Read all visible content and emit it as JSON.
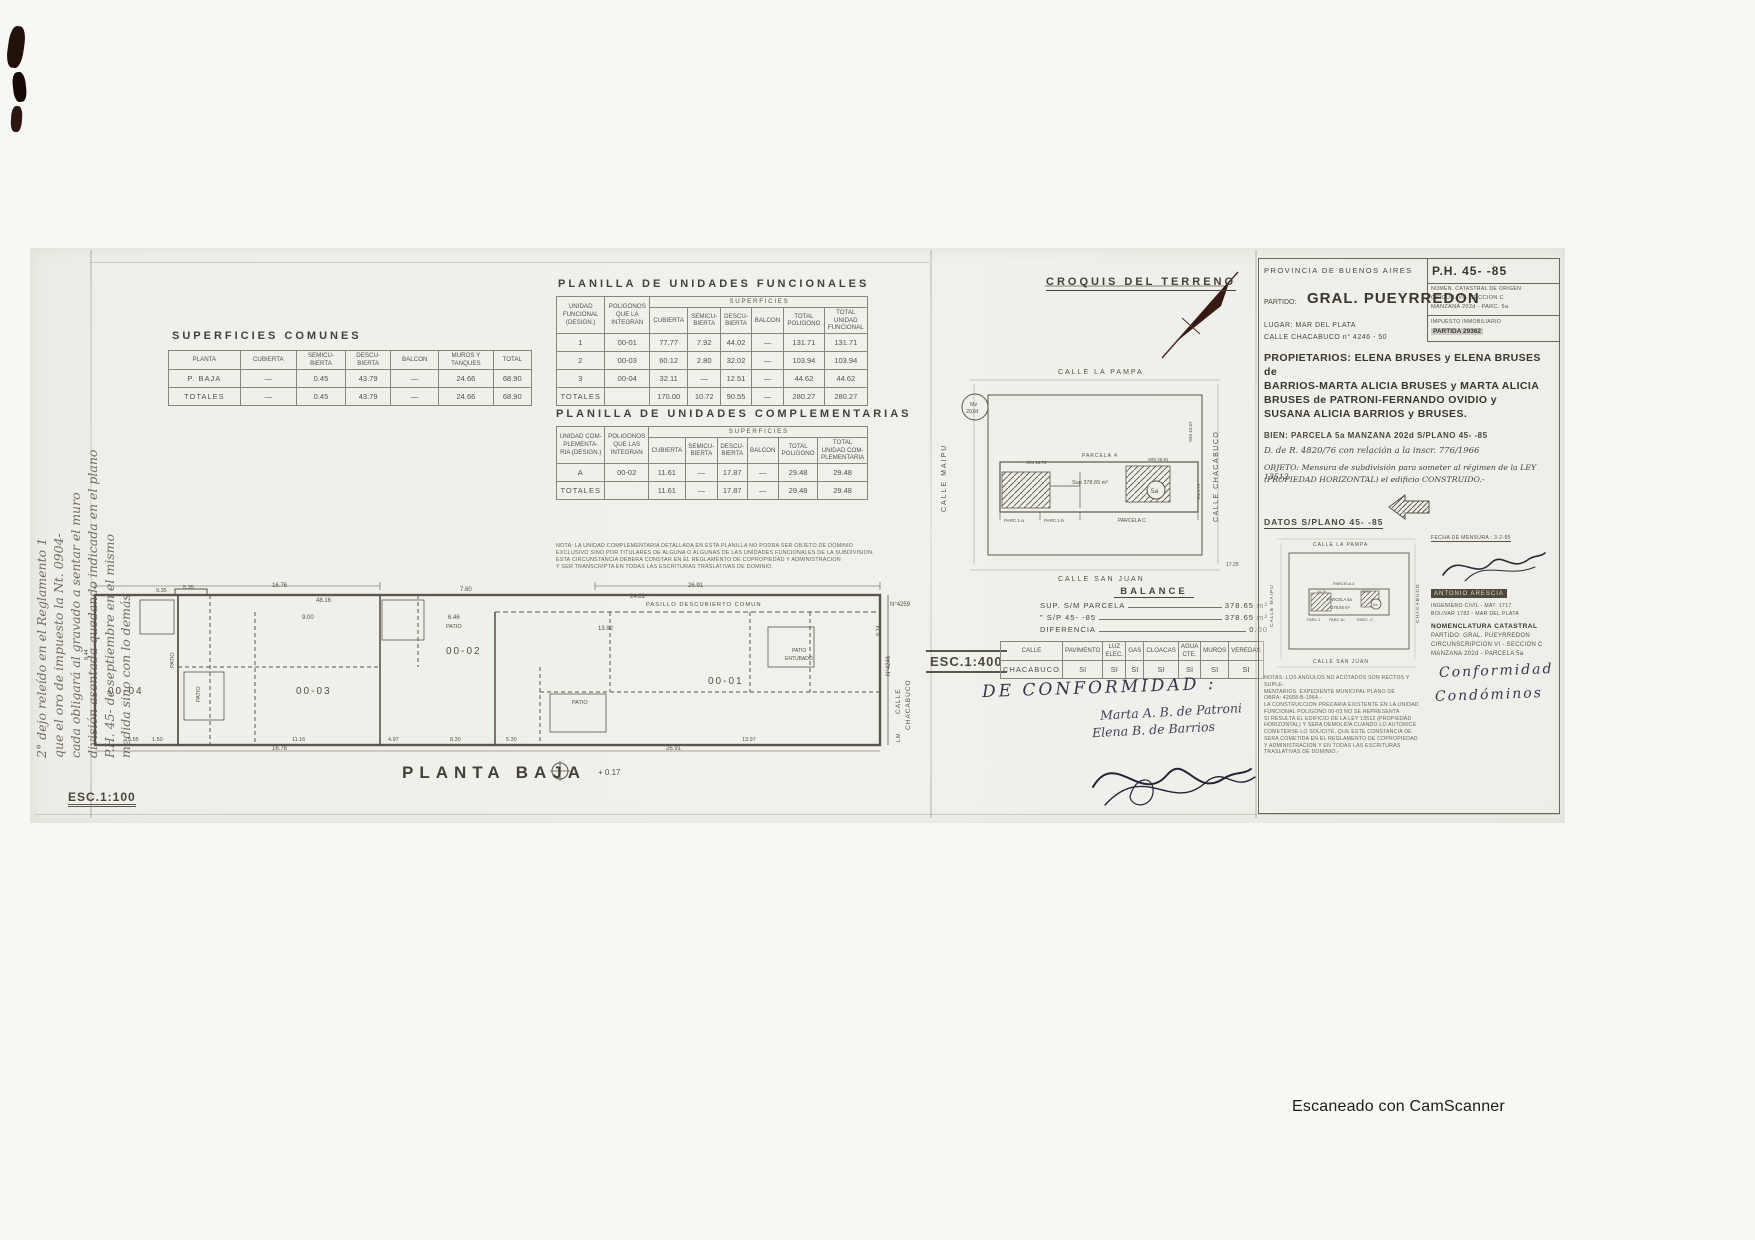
{
  "footer": {
    "camscanner": "Escaneado con CamScanner"
  },
  "margin_note": {
    "lines": [
      "2° dejo releído en el Reglamento 1",
      "que el oro de impuesto la Nt. 0904-",
      "cada obligará al gravado a sentar el muro",
      "división asentada quedando indicada en el plano",
      "P.H. 45- de septiembre en el mismo",
      "medida sino con lo demás"
    ]
  },
  "superficies_comunes": {
    "title": "SUPERFICIES COMUNES",
    "header_rows": [
      [
        {
          "t": "PLANTA"
        },
        {
          "t": "CUBIERTA"
        },
        {
          "t": "SEMICU-\nBIERTA"
        },
        {
          "t": "DESCU-\nBIERTA"
        },
        {
          "t": "BALCON"
        },
        {
          "t": "MUROS Y\nTANQUES"
        },
        {
          "t": "TOTAL"
        }
      ]
    ],
    "rows": [
      [
        "P. BAJA",
        "—",
        "0.45",
        "43.79",
        "—",
        "24.66",
        "68.90"
      ],
      [
        "TOTALES",
        "—",
        "0.45",
        "43.79",
        "—",
        "24.66",
        "68.90"
      ]
    ]
  },
  "unidades_funcionales": {
    "title": "PLANILLA DE UNIDADES FUNCIONALES",
    "header_rows": [
      [
        {
          "t": "UNIDAD\nFUNCIONAL\n(DESIGN.)",
          "r": 2
        },
        {
          "t": "POLIGONOS\nQUE LA\nINTEGRAN",
          "r": 2
        },
        {
          "t": "S U P E R F I C I E S",
          "c": 6
        }
      ],
      [
        {
          "t": "CUBIERTA"
        },
        {
          "t": "SEMICU-\nBIERTA"
        },
        {
          "t": "DESCU-\nBIERTA"
        },
        {
          "t": "BALCON"
        },
        {
          "t": "TOTAL\nPOLIGONO"
        },
        {
          "t": "TOTAL\nUNIDAD\nFUNCIONAL"
        }
      ]
    ],
    "rows": [
      [
        "1",
        "00-01",
        "77.77",
        "7.92",
        "44.02",
        "—",
        "131.71",
        "131.71"
      ],
      [
        "2",
        "00-03",
        "60.12",
        "2.80",
        "32.02",
        "—",
        "103.94",
        "103.94"
      ],
      [
        "3",
        "00-04",
        "32.11",
        "—",
        "12.51",
        "—",
        "44.62",
        "44.62"
      ],
      [
        "TOTALES",
        "",
        "170.00",
        "10.72",
        "90.55",
        "—",
        "280.27",
        "280.27"
      ]
    ]
  },
  "unidades_complementarias": {
    "title": "PLANILLA DE UNIDADES COMPLEMENTARIAS",
    "header_rows": [
      [
        {
          "t": "UNIDAD COM-\nPLEMENTA-\nRIA (DESIGN.)",
          "r": 2
        },
        {
          "t": "POLIGONOS\nQUE LAS\nINTEGRAN",
          "r": 2
        },
        {
          "t": "S U P E R F I C I E S",
          "c": 6
        }
      ],
      [
        {
          "t": "CUBIERTA"
        },
        {
          "t": "SEMICU-\nBIERTA"
        },
        {
          "t": "DESCU-\nBIERTA"
        },
        {
          "t": "BALCON"
        },
        {
          "t": "TOTAL\nPOLIGONO"
        },
        {
          "t": "TOTAL\nUNIDAD COM-\nPLEMENTARIA"
        }
      ]
    ],
    "rows": [
      [
        "A",
        "00-02",
        "11.61",
        "—",
        "17.87",
        "—",
        "29.48",
        "29.48"
      ],
      [
        "TOTALES",
        "",
        "11.61",
        "—",
        "17.87",
        "—",
        "29.48",
        "29.48"
      ]
    ],
    "nota_lines": [
      "NOTA: LA UNIDAD COMPLEMENTARIA DETALLADA EN ESTA PLANILLA NO PODRA SER OBJETO DE DOMINIO",
      "EXCLUSIVO SINO POR TITULARES DE ALGUNA O ALGUNAS DE LAS UNIDADES FUNCIONALES DE LA SUBDIVISION.",
      "ESTA CIRCUNSTANCIA DEBERA CONSTAR EN EL REGLAMENTO DE COPROPIEDAD Y ADMINISTRACION",
      "Y SER TRANSCRIPTA EN TODAS LAS ESCRITURAS TRASLATIVAS DE DOMINIO."
    ]
  },
  "plan": {
    "esc": "ESC.1:100",
    "labels": [
      {
        "t": "9.35",
        "x": 106,
        "y": 20,
        "s": 5.5
      },
      {
        "t": "5.35",
        "x": 133,
        "y": 17,
        "s": 5.5
      },
      {
        "t": "16.76",
        "x": 222,
        "y": 15,
        "s": 6
      },
      {
        "t": "48.16",
        "x": 266,
        "y": 30,
        "s": 6
      },
      {
        "t": "9.00",
        "x": 252,
        "y": 47,
        "s": 6
      },
      {
        "t": "7.60",
        "x": 410,
        "y": 19,
        "s": 6
      },
      {
        "t": "6.46",
        "x": 398,
        "y": 47,
        "s": 6
      },
      {
        "t": "24.81",
        "x": 580,
        "y": 26,
        "s": 6
      },
      {
        "t": "26.91",
        "x": 638,
        "y": 15,
        "s": 6
      },
      {
        "t": "13.92",
        "x": 548,
        "y": 58,
        "s": 6
      },
      {
        "t": "PASILLO  DESCUBIERTO  COMUN",
        "x": 596,
        "y": 34,
        "s": 5.8,
        "sp": 1
      },
      {
        "t": "5.55",
        "x": 78,
        "y": 169,
        "s": 5.5
      },
      {
        "t": "1.50",
        "x": 102,
        "y": 169,
        "s": 5.5
      },
      {
        "t": "16.76",
        "x": 222,
        "y": 178,
        "s": 6
      },
      {
        "t": "11.16",
        "x": 242,
        "y": 169,
        "s": 5.5
      },
      {
        "t": "4.97",
        "x": 338,
        "y": 169,
        "s": 5.5
      },
      {
        "t": "8.30",
        "x": 400,
        "y": 169,
        "s": 5.5
      },
      {
        "t": "5.30",
        "x": 456,
        "y": 169,
        "s": 5.5
      },
      {
        "t": "26.91",
        "x": 616,
        "y": 178,
        "s": 6
      },
      {
        "t": "13.97",
        "x": 692,
        "y": 169,
        "s": 5.5
      },
      {
        "t": "8.44",
        "x": 38,
        "y": 88,
        "s": 5.5,
        "r": -90
      },
      {
        "t": "8.74",
        "x": 830,
        "y": 64,
        "s": 5.5,
        "r": -90
      },
      {
        "t": "N°4259",
        "x": 840,
        "y": 34,
        "s": 6
      },
      {
        "t": "N°4246",
        "x": 840,
        "y": 104,
        "r": -90,
        "s": 6
      },
      {
        "t": "00-04",
        "x": 58,
        "y": 122,
        "s": 10,
        "sp": 2
      },
      {
        "t": "00-03",
        "x": 246,
        "y": 122,
        "s": 10,
        "sp": 2
      },
      {
        "t": "00-02",
        "x": 396,
        "y": 82,
        "s": 10,
        "sp": 2
      },
      {
        "t": "00-01",
        "x": 658,
        "y": 112,
        "s": 10,
        "sp": 2
      },
      {
        "t": "PATIO",
        "x": 124,
        "y": 96,
        "r": -90,
        "s": 5.5
      },
      {
        "t": "PATIO",
        "x": 150,
        "y": 130,
        "r": -90,
        "s": 5.5
      },
      {
        "t": "PATIO",
        "x": 396,
        "y": 56,
        "s": 5.5
      },
      {
        "t": "PATIO",
        "x": 522,
        "y": 132,
        "s": 5.5
      },
      {
        "t": "PATIO",
        "x": 742,
        "y": 80,
        "s": 5
      },
      {
        "t": "ENTUBADO",
        "x": 735,
        "y": 88,
        "s": 5
      },
      {
        "t": "CALLE",
        "x": 850,
        "y": 142,
        "r": -90,
        "s": 6.5,
        "sp": 1
      },
      {
        "t": "CHACABUCO",
        "x": 860,
        "y": 158,
        "r": -90,
        "s": 6.5,
        "sp": 1
      },
      {
        "t": "L.M.",
        "x": 850,
        "y": 170,
        "r": -90,
        "s": 5
      },
      {
        "t": "PLANTA  BAJA",
        "x": 352,
        "y": 206,
        "s": 17,
        "sp": 6,
        "cls": "title"
      },
      {
        "t": "+ 0.17",
        "x": 548,
        "y": 203,
        "s": 8
      }
    ]
  },
  "croquis": {
    "title": "CROQUIS DEL TERRENO",
    "esc": "ESC.1:400",
    "labels": [
      {
        "t": "CALLE  LA  PAMPA",
        "x": 128,
        "y": 114,
        "s": 7,
        "sp": 2
      },
      {
        "t": "CALLE  SAN  JUAN",
        "x": 128,
        "y": 321,
        "s": 7,
        "sp": 2
      },
      {
        "t": "CALLE  MAIPU",
        "x": 16,
        "y": 252,
        "r": -90,
        "s": 7,
        "sp": 2
      },
      {
        "t": "CALLE  CHACABUCO",
        "x": 288,
        "y": 262,
        "r": -90,
        "s": 7,
        "sp": 1.5
      },
      {
        "t": "Mz",
        "x": 40,
        "y": 146,
        "s": 5.5
      },
      {
        "t": "202d",
        "x": 36,
        "y": 153,
        "s": 5.5
      },
      {
        "t": "PARCELA  4",
        "x": 152,
        "y": 197,
        "s": 5,
        "sp": 1
      },
      {
        "t": "S/M 16.76",
        "x": 96,
        "y": 204,
        "s": 4.5
      },
      {
        "t": "S/M 26.91",
        "x": 218,
        "y": 201,
        "s": 4.5
      },
      {
        "t": "Sup 378.65 m²",
        "x": 142,
        "y": 224,
        "s": 5.5
      },
      {
        "t": "5a",
        "x": 221,
        "y": 233,
        "s": 6.5
      },
      {
        "t": "PARC.1-a",
        "x": 74,
        "y": 262,
        "s": 4.5
      },
      {
        "t": "PARC.1-b",
        "x": 114,
        "y": 262,
        "s": 4.5
      },
      {
        "t": "PARCELA  C",
        "x": 188,
        "y": 262,
        "s": 5
      },
      {
        "t": "S/M 43.67",
        "x": 262,
        "y": 182,
        "r": -90,
        "s": 4.5
      },
      {
        "t": "S/M 8.74",
        "x": 270,
        "y": 240,
        "r": -90,
        "s": 4
      },
      {
        "t": "17.25",
        "x": 296,
        "y": 306,
        "s": 5
      }
    ]
  },
  "balance": {
    "title": "BALANCE",
    "rows": [
      [
        "SUP. S/M PARCELA",
        "378.65 m²"
      ],
      [
        "\"    S/P 45-    -85",
        "378.65 m²"
      ],
      [
        "DIFERENCIA",
        "0.00"
      ]
    ]
  },
  "servicios": {
    "header_rows": [
      [
        {
          "t": "CALLE"
        },
        {
          "t": "PAVIMENTO"
        },
        {
          "t": "LUZ ELEC."
        },
        {
          "t": "GAS"
        },
        {
          "t": "CLOACAS"
        },
        {
          "t": "AGUA CTE."
        },
        {
          "t": "MUROS"
        },
        {
          "t": "VEREDAS"
        }
      ]
    ],
    "rows": [
      [
        "CHACABUCO",
        "SI",
        "SI",
        "SI",
        "SI",
        "SI",
        "SI",
        "SI"
      ]
    ]
  },
  "conformidad": {
    "title": "DE CONFORMIDAD :",
    "firmas": [
      "Marta A. B. de Patroni",
      "Elena B. de Barrios"
    ]
  },
  "panel": {
    "provincia": "PROVINCIA DE BUENOS AIRES",
    "ph": "P.H. 45-        -85",
    "nomen_origen": [
      "NOMEN. CATASTRAL DE ORIGEN",
      "CIRCUN. VI - SECCION C",
      "MANZANA 202d - PARC. 5a"
    ],
    "impuesto": "IMPUESTO INMOBILIARIO",
    "partida": "PARTIDA 29362",
    "partido_label": "PARTIDO:",
    "partido": "GRAL. PUEYRREDON",
    "lugar": "LUGAR: MAR DEL PLATA",
    "calle": "CALLE CHACABUCO n° 4246 - 50",
    "propietarios_lines": [
      "PROPIETARIOS: ELENA BRUSES y ELENA BRUSES de",
      "BARRIOS-MARTA ALICIA BRUSES y MARTA ALICIA",
      "BRUSES de PATRONI-FERNANDO OVIDIO y",
      "SUSANA ALICIA BARRIOS y BRUSES."
    ],
    "bien": "BIEN: PARCELA 5a MANZANA 202d  S/PLANO 45-    -85",
    "dder": "D. de R. 4820/76 con relación a la inscr. 776/1966",
    "objeto_lines": [
      "OBJETO: Mensura de subdivisión para someter al régimen de la LEY 13512",
      "(PROPIEDAD HORIZONTAL) el edificio CONSTRUIDO.-"
    ],
    "datos": "DATOS S/PLANO 45-    -85",
    "fecha": "FECHA DE MENSURA : 3-2-85",
    "profesional": {
      "nombre": "ANTONIO ARESCIA",
      "titulo": "INGENIERO CIVIL - MAT. 1717",
      "domicilio": "BOLIVAR 1782 - MAR DEL PLATA"
    },
    "nomenclatura": [
      "NOMENCLATURA CATASTRAL",
      "PARTIDO: GRAL. PUEYRREDON",
      "CIRCUNSCRIPCION VI - SECCION C",
      "MANZANA 202d - PARCELA 5a"
    ],
    "conformidad_hand": [
      "Conformidad",
      "Condóminos"
    ],
    "mini_croquis_labels": [
      {
        "t": "CALLE LA PAMPA",
        "x": 52,
        "y": 15,
        "s": 5,
        "sp": 1
      },
      {
        "t": "CALLE SAN JUAN",
        "x": 52,
        "y": 132,
        "s": 5,
        "sp": 1
      },
      {
        "t": "CALLE MAIPU",
        "x": 12,
        "y": 96,
        "r": -90,
        "s": 4.8,
        "sp": 1
      },
      {
        "t": "CHACABUCO",
        "x": 158,
        "y": 92,
        "r": -90,
        "s": 4.8,
        "sp": 1
      },
      {
        "t": "PARCELA 4",
        "x": 72,
        "y": 54,
        "s": 4
      },
      {
        "t": "16.76",
        "x": 56,
        "y": 62,
        "s": 3.8
      },
      {
        "t": "26.91",
        "x": 100,
        "y": 62,
        "s": 3.8
      },
      {
        "t": "PARCELA 5a",
        "x": 66,
        "y": 70,
        "s": 4.2
      },
      {
        "t": "378.65 m²",
        "x": 70,
        "y": 78,
        "s": 4.2
      },
      {
        "t": "5a",
        "x": 112,
        "y": 75,
        "s": 4
      },
      {
        "t": "PARC.1",
        "x": 46,
        "y": 90,
        "s": 3.8
      },
      {
        "t": "PARC.1b",
        "x": 68,
        "y": 90,
        "s": 3.8
      },
      {
        "t": "PARC. C",
        "x": 96,
        "y": 90,
        "s": 4
      }
    ],
    "notas_lines": [
      "NOTAS: LOS ANGULOS NO ACOTADOS SON RECTOS Y SUPLE-",
      "MENTARIOS.  EXPEDIENTE MUNICIPAL PLANO DE",
      "OBRA: 42658-B-1964.-",
      "LA CONSTRUCCION PRECARIA EXISTENTE EN LA UNIDAD",
      "FUNCIONAL POLIGONO 00-03 NO SE REPRESENTA",
      "SI RESULTA EL EDIFICIO DE LA LEY 13512 (PROPIEDAD",
      "HORIZONTAL) Y SERA DEMOLIDA CUANDO LO AUTORICE",
      "COMETERSE LO SOLICITE, QUE ESTE CONSTANCIA DE",
      "SERA COMETIDA EN EL REGLAMENTO DE COPROPIEDAD",
      "Y ADMINISTRACION Y EN TODAS LAS ESCRITURAS",
      "TRASLATIVAS DE DOMINIO.-"
    ]
  }
}
